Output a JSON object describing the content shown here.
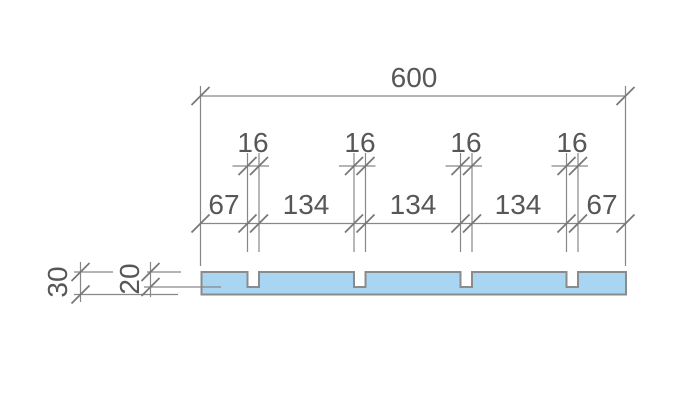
{
  "drawing": {
    "overall_width": "600",
    "groove_widths": [
      "16",
      "16",
      "16",
      "16"
    ],
    "chain": [
      "67",
      "134",
      "134",
      "134",
      "67"
    ],
    "thickness": "30",
    "groove_depth": "20"
  },
  "colors": {
    "panel_fill": "#a8d5f2",
    "panel_stroke": "#8b8b8b",
    "dimension_lines": "#878787",
    "label_text": "#575757"
  }
}
